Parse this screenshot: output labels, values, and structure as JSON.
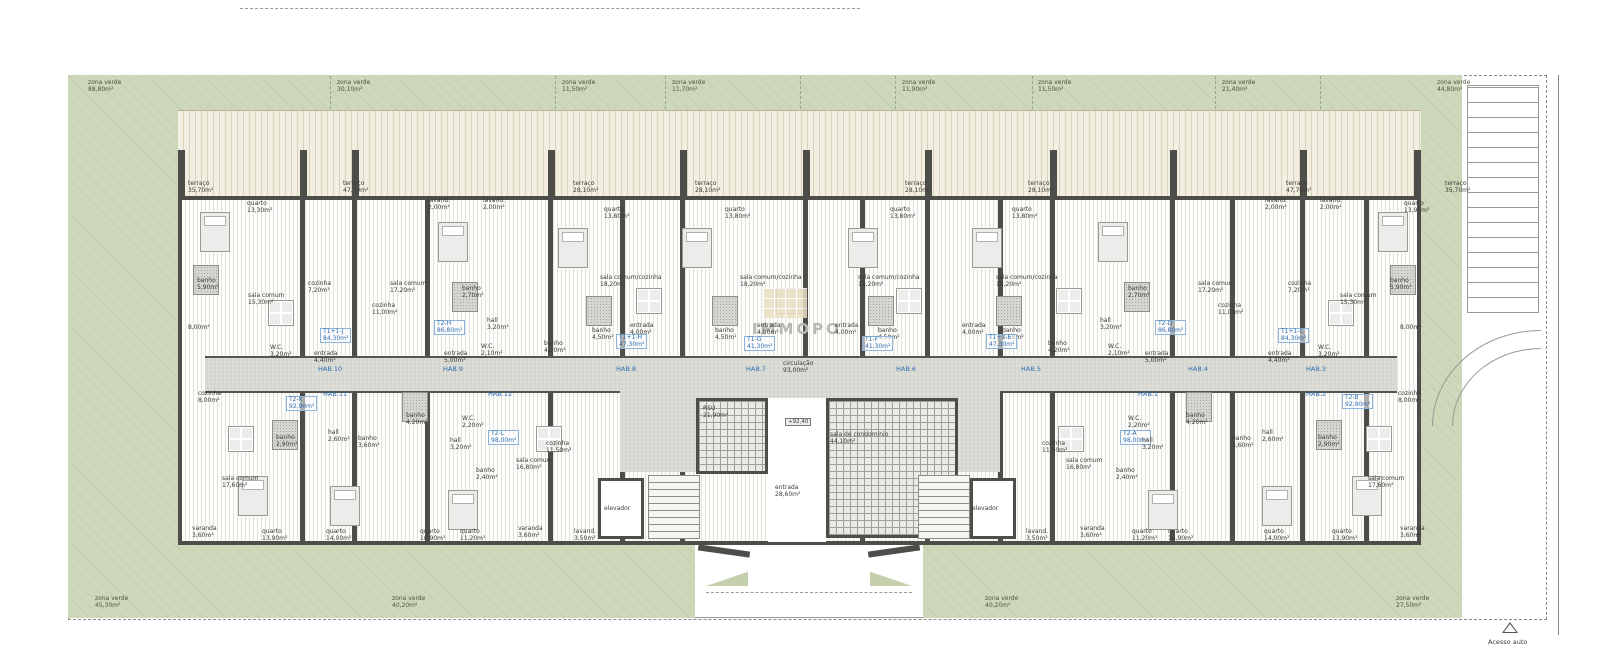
{
  "watermark": {
    "text": "IMMOPO"
  },
  "access": {
    "label": "Acesso auto"
  },
  "colors": {
    "green": "#ccd6b8",
    "wall": "#4d4d4a",
    "terrace": "#f3efe0",
    "corridor": "#dcdcd7",
    "unit_blue": "#2f6fb4"
  },
  "labels": [
    {
      "k": "zone",
      "t": "zona verde",
      "a": "88,80m²",
      "x": 88,
      "y": 80
    },
    {
      "k": "zone",
      "t": "zona verde",
      "a": "30,10m²",
      "x": 337,
      "y": 80
    },
    {
      "k": "zone",
      "t": "zona verde",
      "a": "11,50m²",
      "x": 562,
      "y": 80
    },
    {
      "k": "zone",
      "t": "zona verde",
      "a": "11,70m²",
      "x": 672,
      "y": 80
    },
    {
      "k": "zone",
      "t": "zona verde",
      "a": "11,90m²",
      "x": 902,
      "y": 80
    },
    {
      "k": "zone",
      "t": "zona verde",
      "a": "11,50m²",
      "x": 1038,
      "y": 80
    },
    {
      "k": "zone",
      "t": "zona verde",
      "a": "21,40m²",
      "x": 1222,
      "y": 80
    },
    {
      "k": "zone",
      "t": "zona verde",
      "a": "44,80m²",
      "x": 1437,
      "y": 80
    },
    {
      "k": "zone",
      "t": "zona verde",
      "a": "45,30m²",
      "x": 95,
      "y": 596
    },
    {
      "k": "zone",
      "t": "zona verde",
      "a": "40,20m²",
      "x": 392,
      "y": 596
    },
    {
      "k": "zone",
      "t": "zona verde",
      "a": "40,20m²",
      "x": 985,
      "y": 596
    },
    {
      "k": "zone",
      "t": "zona verde",
      "a": "27,50m²",
      "x": 1396,
      "y": 596
    },
    {
      "k": "room",
      "t": "terraço",
      "a": "35,70m²",
      "x": 188,
      "y": 181
    },
    {
      "k": "room",
      "t": "terraço",
      "a": "47,70m²",
      "x": 343,
      "y": 181
    },
    {
      "k": "room",
      "t": "terraço",
      "a": "28,10m²",
      "x": 573,
      "y": 181
    },
    {
      "k": "room",
      "t": "terraço",
      "a": "28,10m²",
      "x": 695,
      "y": 181
    },
    {
      "k": "room",
      "t": "terraço",
      "a": "28,10m²",
      "x": 905,
      "y": 181
    },
    {
      "k": "room",
      "t": "terraço",
      "a": "28,10m²",
      "x": 1028,
      "y": 181
    },
    {
      "k": "room",
      "t": "terraço",
      "a": "47,70m²",
      "x": 1286,
      "y": 181
    },
    {
      "k": "room",
      "t": "terraço",
      "a": "35,70m²",
      "x": 1445,
      "y": 181
    },
    {
      "k": "room",
      "t": "quarto",
      "a": "13,30m²",
      "x": 247,
      "y": 201
    },
    {
      "k": "room",
      "t": "lavand.",
      "a": "2,00m²",
      "x": 428,
      "y": 198
    },
    {
      "k": "room",
      "t": "lavand.",
      "a": "2,00m²",
      "x": 483,
      "y": 198
    },
    {
      "k": "room",
      "t": "quarto",
      "a": "13,80m²",
      "x": 604,
      "y": 207
    },
    {
      "k": "room",
      "t": "quarto",
      "a": "13,80m²",
      "x": 725,
      "y": 207
    },
    {
      "k": "room",
      "t": "quarto",
      "a": "13,80m²",
      "x": 890,
      "y": 207
    },
    {
      "k": "room",
      "t": "quarto",
      "a": "13,80m²",
      "x": 1012,
      "y": 207
    },
    {
      "k": "room",
      "t": "lavand.",
      "a": "2,00m²",
      "x": 1265,
      "y": 198
    },
    {
      "k": "room",
      "t": "lavand.",
      "a": "2,00m²",
      "x": 1320,
      "y": 198
    },
    {
      "k": "room",
      "t": "quarto",
      "a": "13,90m²",
      "x": 1404,
      "y": 201
    },
    {
      "k": "room",
      "t": "banho",
      "a": "5,90m²",
      "x": 197,
      "y": 278
    },
    {
      "k": "room",
      "t": "sala comum",
      "a": "15,30m²",
      "x": 248,
      "y": 293
    },
    {
      "k": "room",
      "t": "cozinha",
      "a": "7,20m²",
      "x": 308,
      "y": 281
    },
    {
      "k": "room",
      "t": "8,00m²",
      "x": 188,
      "y": 325
    },
    {
      "k": "room",
      "t": "W.C.",
      "a": "3,20m²",
      "x": 270,
      "y": 345
    },
    {
      "k": "room",
      "t": "entrada",
      "a": "4,40m²",
      "x": 314,
      "y": 351
    },
    {
      "k": "room",
      "t": "sala comum",
      "a": "17,20m²",
      "x": 390,
      "y": 281
    },
    {
      "k": "room",
      "t": "cozinha",
      "a": "11,00m²",
      "x": 372,
      "y": 303
    },
    {
      "k": "room",
      "t": "banho",
      "a": "2,70m²",
      "x": 462,
      "y": 286
    },
    {
      "k": "room",
      "t": "hall",
      "a": "3,20m²",
      "x": 487,
      "y": 318
    },
    {
      "k": "room",
      "t": "W.C.",
      "a": "2,10m²",
      "x": 481,
      "y": 344
    },
    {
      "k": "room",
      "t": "entrada",
      "a": "5,00m²",
      "x": 444,
      "y": 351
    },
    {
      "k": "room",
      "t": "sala comum/cozinha",
      "a": "18,20m²",
      "x": 600,
      "y": 275
    },
    {
      "k": "room",
      "t": "banho",
      "a": "4,50m²",
      "x": 592,
      "y": 328
    },
    {
      "k": "room",
      "t": "banho",
      "a": "4,20m²",
      "x": 544,
      "y": 341
    },
    {
      "k": "room",
      "t": "entrada",
      "a": "4,00m²",
      "x": 630,
      "y": 323
    },
    {
      "k": "room",
      "t": "sala comum/cozinha",
      "a": "18,20m²",
      "x": 740,
      "y": 275
    },
    {
      "k": "room",
      "t": "banho",
      "a": "4,50m²",
      "x": 715,
      "y": 328
    },
    {
      "k": "room",
      "t": "entrada",
      "a": "4,00m²",
      "x": 757,
      "y": 323
    },
    {
      "k": "room",
      "t": "sala comum/cozinha",
      "a": "18,20m²",
      "x": 858,
      "y": 275
    },
    {
      "k": "room",
      "t": "banho",
      "a": "4,50m²",
      "x": 878,
      "y": 328
    },
    {
      "k": "room",
      "t": "entrada",
      "a": "4,00m²",
      "x": 835,
      "y": 323
    },
    {
      "k": "room",
      "t": "sala comum/cozinha",
      "a": "18,20m²",
      "x": 996,
      "y": 275
    },
    {
      "k": "room",
      "t": "banho",
      "a": "4,50m²",
      "x": 1002,
      "y": 328
    },
    {
      "k": "room",
      "t": "entrada",
      "a": "4,00m²",
      "x": 962,
      "y": 323
    },
    {
      "k": "room",
      "t": "banho",
      "a": "4,20m²",
      "x": 1048,
      "y": 341
    },
    {
      "k": "room",
      "t": "sala comum",
      "a": "17,20m²",
      "x": 1198,
      "y": 281
    },
    {
      "k": "room",
      "t": "cozinha",
      "a": "11,00m²",
      "x": 1218,
      "y": 303
    },
    {
      "k": "room",
      "t": "banho",
      "a": "2,70m²",
      "x": 1128,
      "y": 286
    },
    {
      "k": "room",
      "t": "hall",
      "a": "3,20m²",
      "x": 1100,
      "y": 318
    },
    {
      "k": "room",
      "t": "W.C.",
      "a": "2,10m²",
      "x": 1108,
      "y": 344
    },
    {
      "k": "room",
      "t": "entrada",
      "a": "5,00m²",
      "x": 1145,
      "y": 351
    },
    {
      "k": "room",
      "t": "sala comum",
      "a": "15,30m²",
      "x": 1340,
      "y": 293
    },
    {
      "k": "room",
      "t": "banho",
      "a": "5,90m²",
      "x": 1390,
      "y": 278
    },
    {
      "k": "room",
      "t": "cozinha",
      "a": "7,20m²",
      "x": 1288,
      "y": 281
    },
    {
      "k": "room",
      "t": "W.C.",
      "a": "3,20m²",
      "x": 1318,
      "y": 345
    },
    {
      "k": "room",
      "t": "entrada",
      "a": "4,40m²",
      "x": 1268,
      "y": 351
    },
    {
      "k": "room",
      "t": "8,00m²",
      "x": 1400,
      "y": 325
    },
    {
      "k": "unit",
      "t": "T1+1-J",
      "a": "84,30m²",
      "x": 320,
      "y": 328
    },
    {
      "k": "unit",
      "t": "T2-H",
      "a": "86,80m²",
      "x": 434,
      "y": 320
    },
    {
      "k": "unit",
      "t": "T1+1-H",
      "a": "47,30m²",
      "x": 616,
      "y": 334
    },
    {
      "k": "unit",
      "t": "T1-G",
      "a": "41,30m²",
      "x": 744,
      "y": 336
    },
    {
      "k": "unit",
      "t": "T1-F",
      "a": "41,30m²",
      "x": 862,
      "y": 336
    },
    {
      "k": "unit",
      "t": "T1+1-E",
      "a": "47,30m²",
      "x": 986,
      "y": 334
    },
    {
      "k": "unit",
      "t": "T2-D",
      "a": "86,80m²",
      "x": 1155,
      "y": 320
    },
    {
      "k": "unit",
      "t": "T1+1-C",
      "a": "84,30m²",
      "x": 1278,
      "y": 328
    },
    {
      "k": "unit",
      "t": "T2-K",
      "a": "92,90m²",
      "x": 286,
      "y": 396
    },
    {
      "k": "unit",
      "t": "T2-L",
      "a": "98,00m²",
      "x": 488,
      "y": 430
    },
    {
      "k": "unit",
      "t": "T2-A",
      "a": "98,00m²",
      "x": 1120,
      "y": 430
    },
    {
      "k": "unit",
      "t": "T2-B",
      "a": "92,90m²",
      "x": 1342,
      "y": 394
    },
    {
      "k": "hab",
      "t": "HAB.10",
      "x": 318,
      "y": 366
    },
    {
      "k": "hab",
      "t": "HAB.9",
      "x": 443,
      "y": 366
    },
    {
      "k": "hab",
      "t": "HAB.8",
      "x": 616,
      "y": 366
    },
    {
      "k": "hab",
      "t": "HAB.7",
      "x": 746,
      "y": 366
    },
    {
      "k": "hab",
      "t": "HAB.6",
      "x": 896,
      "y": 366
    },
    {
      "k": "hab",
      "t": "HAB.5",
      "x": 1021,
      "y": 366
    },
    {
      "k": "hab",
      "t": "HAB.4",
      "x": 1188,
      "y": 366
    },
    {
      "k": "hab",
      "t": "HAB.3",
      "x": 1306,
      "y": 366
    },
    {
      "k": "hab",
      "t": "HAB.11",
      "x": 323,
      "y": 391
    },
    {
      "k": "hab",
      "t": "HAB.12",
      "x": 488,
      "y": 391
    },
    {
      "k": "hab",
      "t": "HAB.1",
      "x": 1138,
      "y": 391
    },
    {
      "k": "hab",
      "t": "HAB.2",
      "x": 1306,
      "y": 391
    },
    {
      "k": "room",
      "t": "circulação",
      "a": "93,00m²",
      "x": 783,
      "y": 361
    },
    {
      "k": "level",
      "t": "+92,40",
      "x": 785,
      "y": 418
    },
    {
      "k": "room",
      "t": "RSU",
      "a": "21,90m²",
      "x": 703,
      "y": 406
    },
    {
      "k": "room",
      "t": "sala de condomínio",
      "a": "44,10m²",
      "x": 830,
      "y": 432
    },
    {
      "k": "room",
      "t": "entrada",
      "a": "28,60m²",
      "x": 775,
      "y": 485
    },
    {
      "k": "room",
      "t": "elevador",
      "x": 604,
      "y": 506
    },
    {
      "k": "room",
      "t": "elevador",
      "x": 972,
      "y": 506
    },
    {
      "k": "room",
      "t": "cozinha",
      "a": "8,00m²",
      "x": 198,
      "y": 391
    },
    {
      "k": "room",
      "t": "sala comum",
      "a": "17,60m²",
      "x": 222,
      "y": 476
    },
    {
      "k": "room",
      "t": "banho",
      "a": "2,90m²",
      "x": 276,
      "y": 435
    },
    {
      "k": "room",
      "t": "hall",
      "a": "2,60m²",
      "x": 328,
      "y": 430
    },
    {
      "k": "room",
      "t": "banho",
      "a": "3,60m²",
      "x": 358,
      "y": 436
    },
    {
      "k": "room",
      "t": "banho",
      "a": "4,20m²",
      "x": 406,
      "y": 413
    },
    {
      "k": "room",
      "t": "W.C.",
      "a": "2,20m²",
      "x": 462,
      "y": 416
    },
    {
      "k": "room",
      "t": "hall",
      "a": "3,20m²",
      "x": 450,
      "y": 438
    },
    {
      "k": "room",
      "t": "banho",
      "a": "2,40m²",
      "x": 476,
      "y": 468
    },
    {
      "k": "room",
      "t": "cozinha",
      "a": "11,50m²",
      "x": 546,
      "y": 441
    },
    {
      "k": "room",
      "t": "sala comum",
      "a": "16,80m²",
      "x": 516,
      "y": 458
    },
    {
      "k": "room",
      "t": "cozinha",
      "a": "8,00m²",
      "x": 1398,
      "y": 391
    },
    {
      "k": "room",
      "t": "sala comum",
      "a": "17,60m²",
      "x": 1368,
      "y": 476
    },
    {
      "k": "room",
      "t": "banho",
      "a": "2,90m²",
      "x": 1318,
      "y": 435
    },
    {
      "k": "room",
      "t": "hall",
      "a": "2,60m²",
      "x": 1262,
      "y": 430
    },
    {
      "k": "room",
      "t": "banho",
      "a": "3,60m²",
      "x": 1232,
      "y": 436
    },
    {
      "k": "room",
      "t": "banho",
      "a": "4,20m²",
      "x": 1186,
      "y": 413
    },
    {
      "k": "room",
      "t": "W.C.",
      "a": "2,20m²",
      "x": 1128,
      "y": 416
    },
    {
      "k": "room",
      "t": "hall",
      "a": "3,20m²",
      "x": 1142,
      "y": 438
    },
    {
      "k": "room",
      "t": "banho",
      "a": "2,40m²",
      "x": 1116,
      "y": 468
    },
    {
      "k": "room",
      "t": "cozinha",
      "a": "11,50m²",
      "x": 1042,
      "y": 441
    },
    {
      "k": "room",
      "t": "sala comum",
      "a": "16,80m²",
      "x": 1066,
      "y": 458
    },
    {
      "k": "room",
      "t": "varanda",
      "a": "3,60m²",
      "x": 192,
      "y": 526
    },
    {
      "k": "room",
      "t": "quarto",
      "a": "13,90m²",
      "x": 262,
      "y": 529
    },
    {
      "k": "room",
      "t": "quarto",
      "a": "14,00m²",
      "x": 326,
      "y": 529
    },
    {
      "k": "room",
      "t": "quarto",
      "a": "16,90m²",
      "x": 420,
      "y": 529
    },
    {
      "k": "room",
      "t": "quarto",
      "a": "11,20m²",
      "x": 460,
      "y": 529
    },
    {
      "k": "room",
      "t": "varanda",
      "a": "3,60m²",
      "x": 518,
      "y": 526
    },
    {
      "k": "room",
      "t": "lavand.",
      "a": "3,50m²",
      "x": 574,
      "y": 529
    },
    {
      "k": "room",
      "t": "lavand.",
      "a": "3,50m²",
      "x": 1026,
      "y": 529
    },
    {
      "k": "room",
      "t": "varanda",
      "a": "3,60m²",
      "x": 1080,
      "y": 526
    },
    {
      "k": "room",
      "t": "quarto",
      "a": "11,20m²",
      "x": 1132,
      "y": 529
    },
    {
      "k": "room",
      "t": "quarto",
      "a": "16,90m²",
      "x": 1168,
      "y": 529
    },
    {
      "k": "room",
      "t": "quarto",
      "a": "14,00m²",
      "x": 1264,
      "y": 529
    },
    {
      "k": "room",
      "t": "quarto",
      "a": "13,90m²",
      "x": 1332,
      "y": 529
    },
    {
      "k": "room",
      "t": "varanda",
      "a": "3,60m²",
      "x": 1400,
      "y": 526
    }
  ]
}
